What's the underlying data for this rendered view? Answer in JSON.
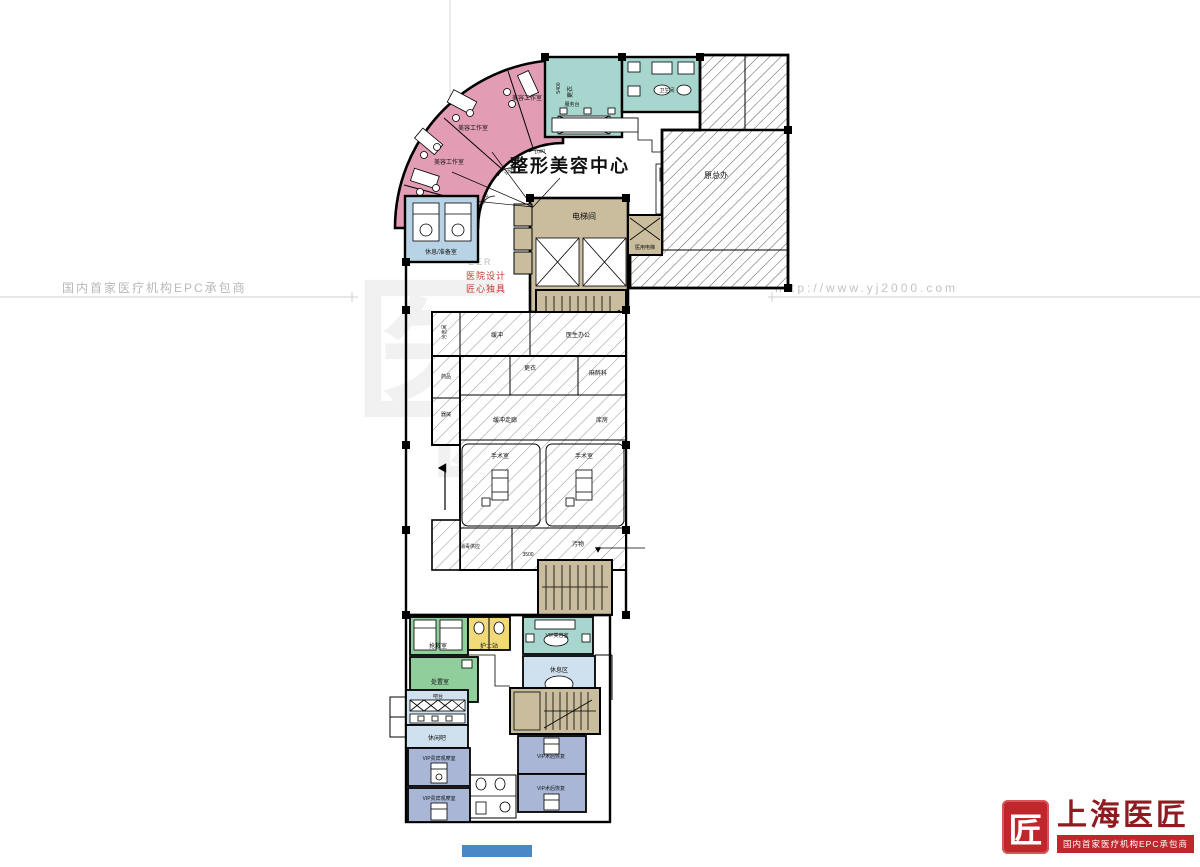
{
  "watermark": {
    "left_text": "国内首家医疗机构EPC承包商",
    "right_url": "http://www.yj2000.com",
    "center_glyph": "医",
    "center_glyph2": "匠",
    "center_eer": "EER",
    "center_line1": "医院设计",
    "center_line2": "匠心独具"
  },
  "logo": {
    "seal_char": "匠",
    "brand": "上海医匠",
    "tagline": "国内首家医疗机构EPC承包商"
  },
  "plan": {
    "title": "整形美容中心",
    "labels": {
      "studio1": "美容工作室",
      "studio2": "美容工作室",
      "studio3": "美容工作室",
      "dim_1000a": "1000",
      "dim_1000b": "1000",
      "dim_1000c": "1000",
      "changing_top": "更衣",
      "dim_5400": "5400",
      "toilet_top": "卫生间",
      "service_desk": "服务台",
      "original_block": "原总办",
      "elevator_hall": "电梯间",
      "medical_elevator": "医用电梯",
      "rest_prep": "休息/准备室",
      "dirty_wash": "污洗间",
      "buffer": "缓冲",
      "doctor_office": "医生办公",
      "medicine": "药品",
      "instruments": "器械",
      "changing_mid": "更衣",
      "anesthesia": "麻醉科",
      "buffer_corridor": "缓冲走廊",
      "storage": "库房",
      "or1": "手术室",
      "or2": "手术室",
      "disinfect_supply": "消毒供应",
      "dirty_corridor": "污物",
      "dim_3500": "3500",
      "rescue": "抢救室",
      "disposal": "处置室",
      "nurse_station": "护士站",
      "vip_beauty": "VIP美容室",
      "rest_area": "休息区",
      "bar_counter": "吧台",
      "leisure_bar": "休闲吧",
      "vip_observe1": "VIP贵宾观摩室",
      "vip_observe2": "VIP贵宾观摩室",
      "vip_recovery1": "VIP术后恢复",
      "vip_recovery2": "VIP术后恢复"
    },
    "colors": {
      "pink": "#e29db4",
      "teal": "#a7d6cf",
      "tan": "#c9bd9e",
      "blue_light": "#b9d3e6",
      "blue_pale": "#cfe0ee",
      "green": "#90cf9c",
      "yellow": "#f2d977",
      "purple": "#a9b6d6",
      "blue_strip": "#4a86c8"
    }
  }
}
